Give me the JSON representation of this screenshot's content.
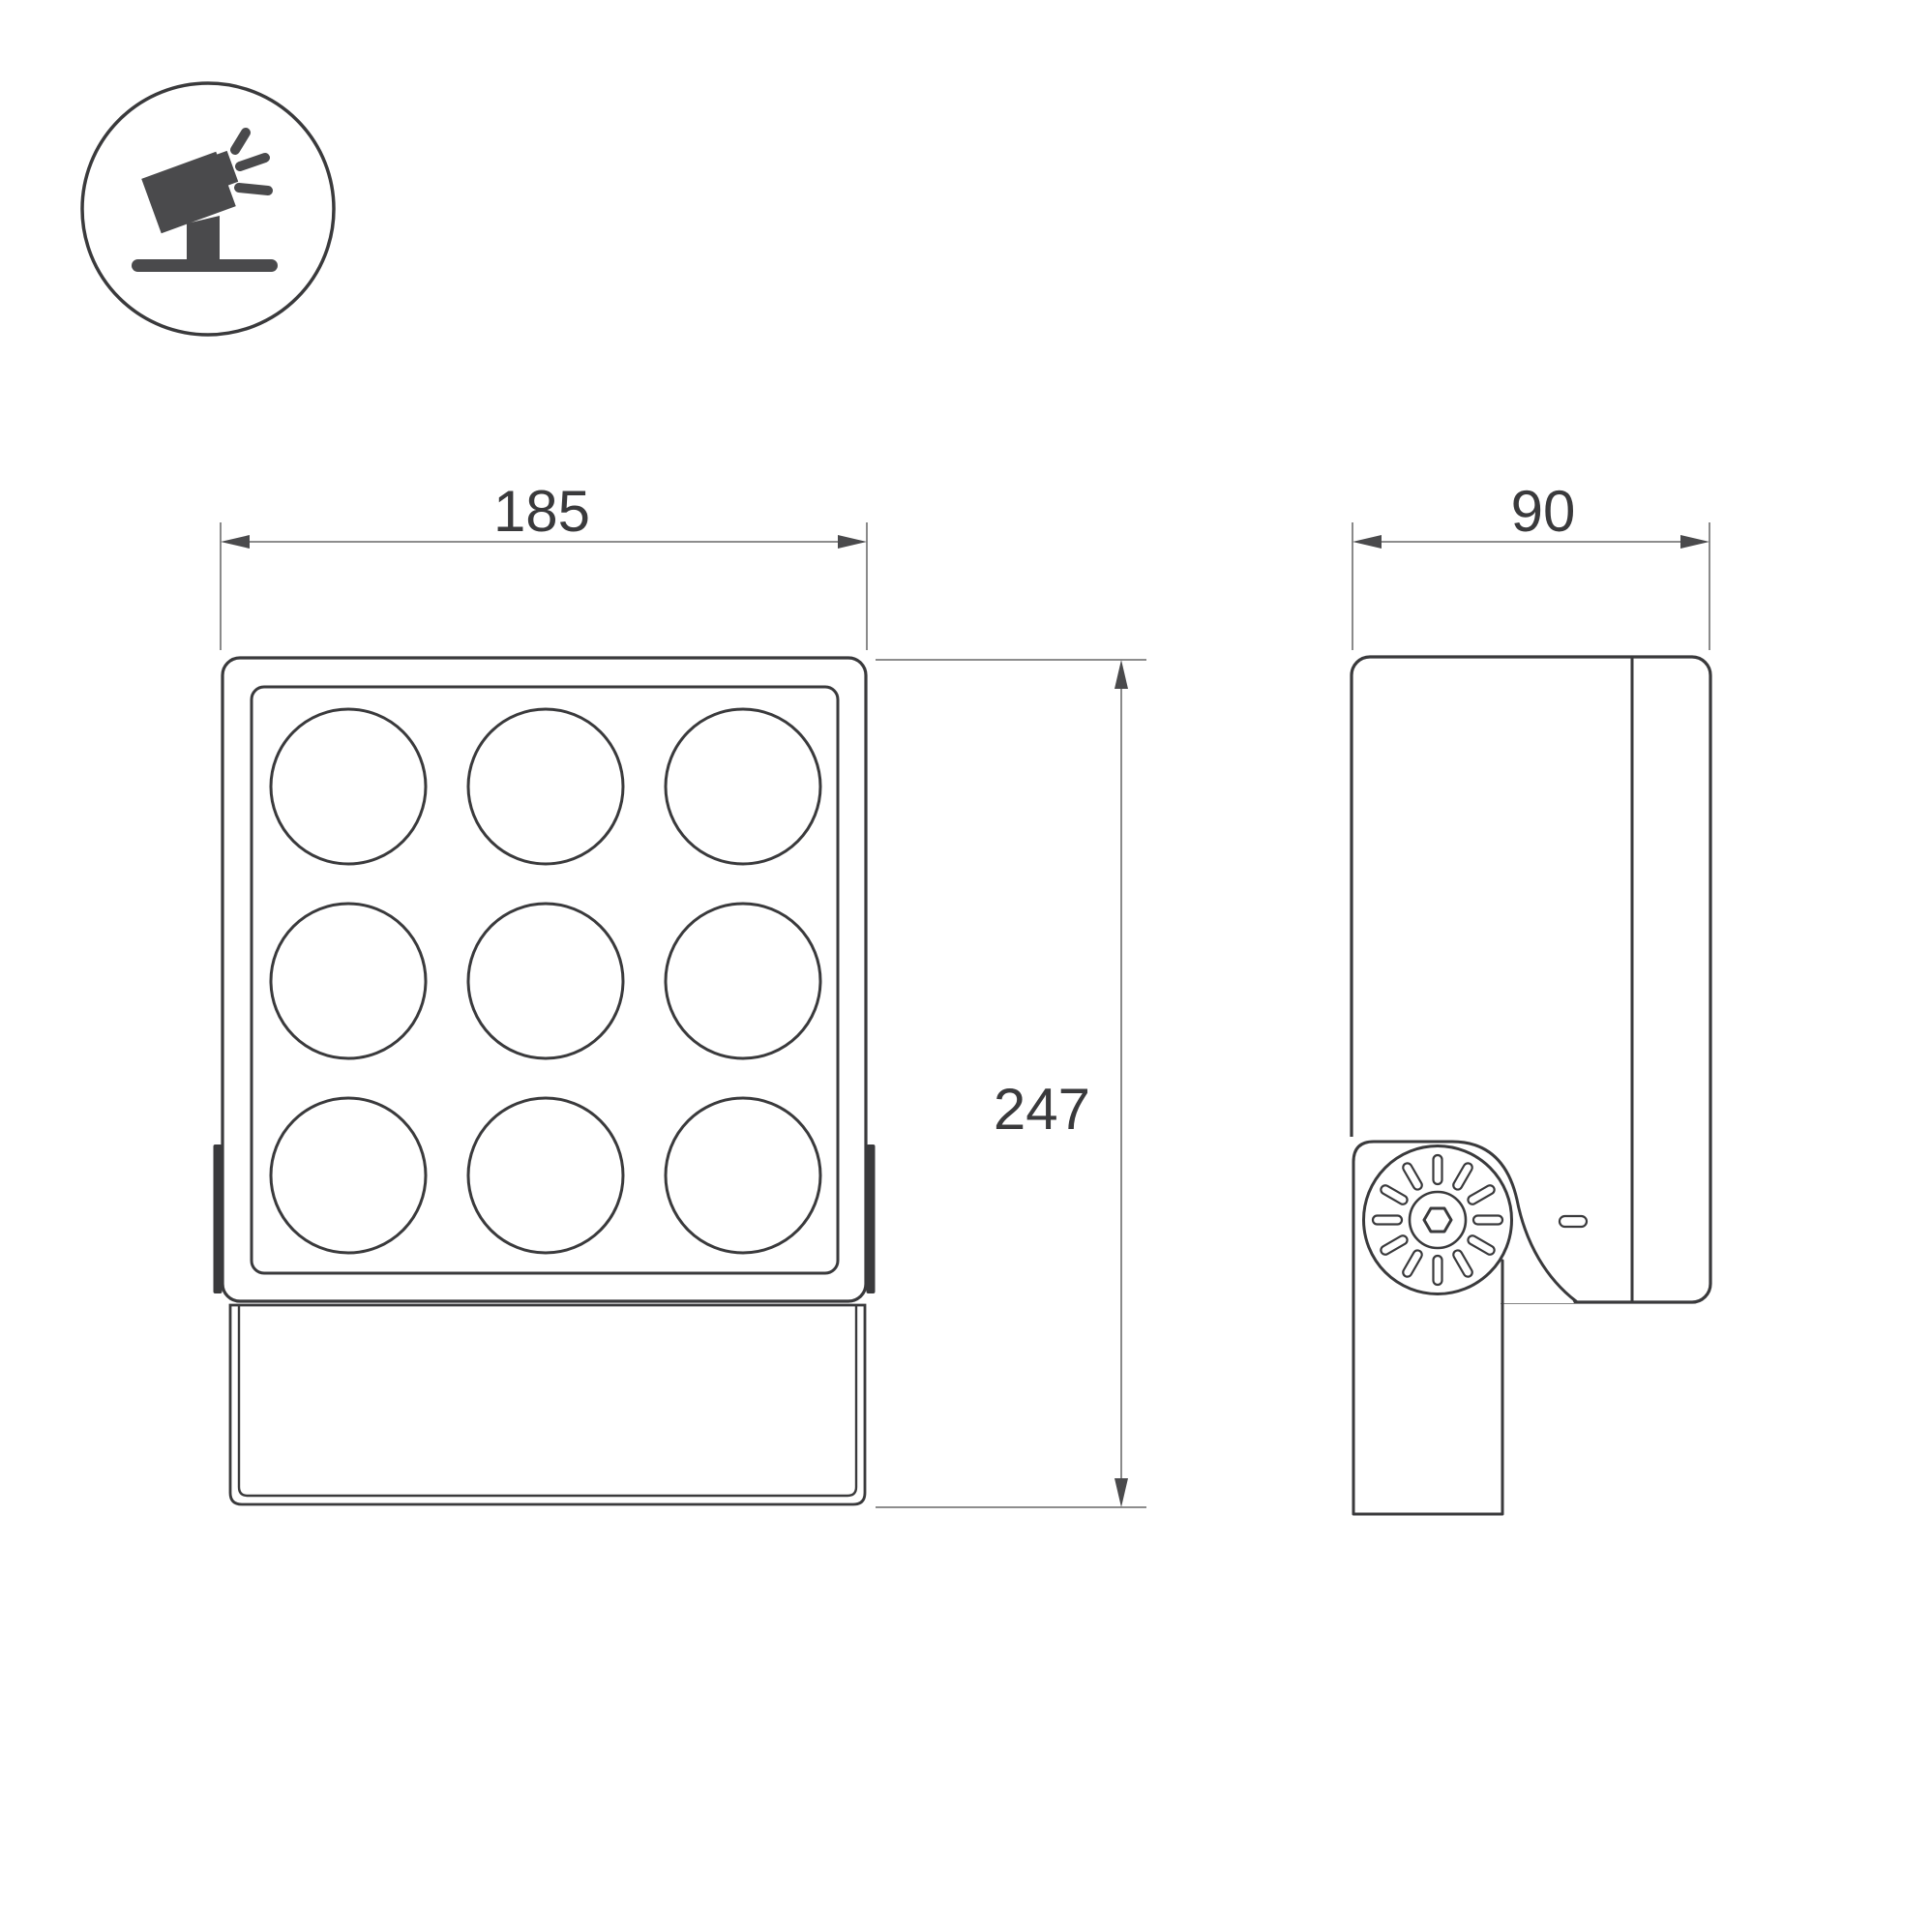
{
  "icon": {
    "name": "tilted-floodlight-on-stand-icon"
  },
  "dimensions": {
    "front_width": "185",
    "front_height": "247",
    "side_depth": "90"
  },
  "front_view": {
    "led_rows": 3,
    "led_cols": 3,
    "led_count": 9
  },
  "side_view": {
    "knob_slot_count": 12
  },
  "colors": {
    "outline_dark": "#3a3a3c",
    "dimension_gray": "#7d7d7d",
    "arrow_dark": "#4a4a4c",
    "icon_fill": "#4a4a4c",
    "background": "#ffffff"
  }
}
